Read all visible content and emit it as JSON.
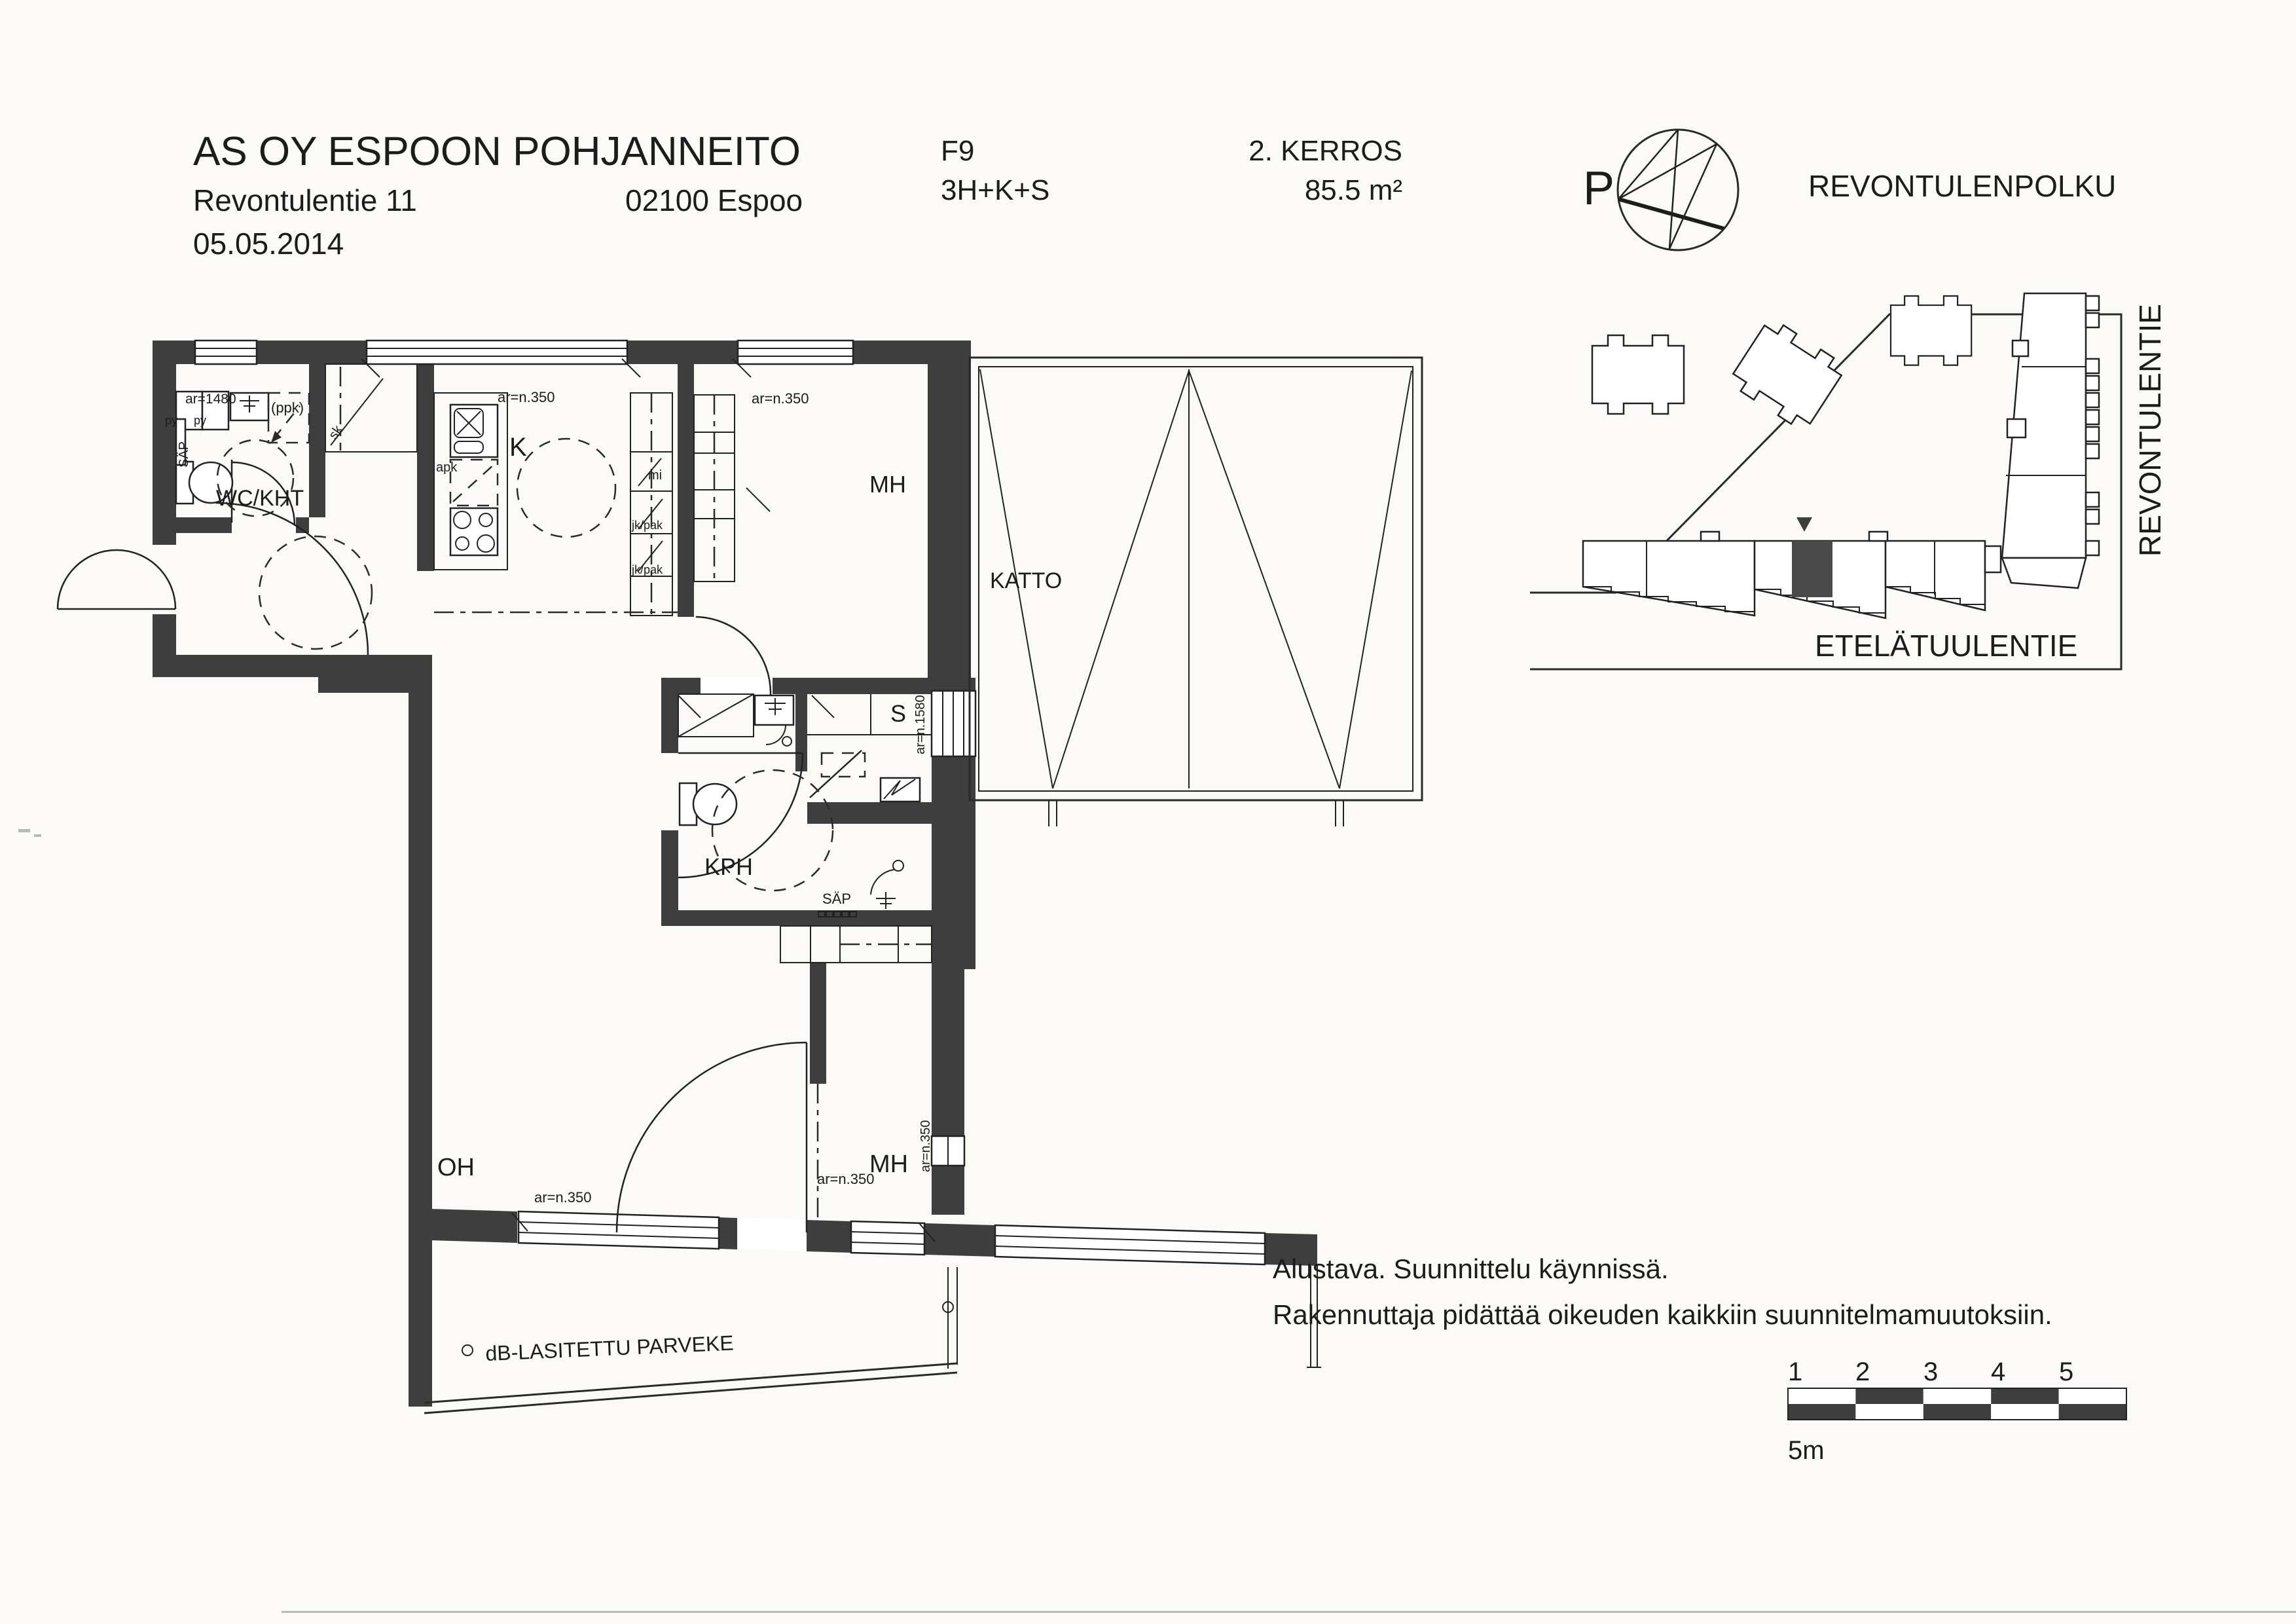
{
  "header": {
    "company": "AS OY ESPOON POHJANNEITO",
    "street_address": "Revontulentie 11",
    "postal_city": "02100 Espoo",
    "date": "05.05.2014",
    "apartment_id": "F9",
    "apartment_type": "3H+K+S",
    "floor_label": "2. KERROS",
    "area_label": "85.5 m²"
  },
  "compass": {
    "label": "P"
  },
  "site_plan": {
    "street_north": "REVONTULENPOLKU",
    "street_east": "REVONTULENTIE",
    "street_south": "ETELÄTUULENTIE"
  },
  "floor_plan": {
    "rooms": {
      "wc_utility": "WC/KHT",
      "kitchen": "K",
      "bedroom_top": "MH",
      "roof": "KATTO",
      "sauna": "S",
      "bathroom": "KPH",
      "living_room": "OH",
      "bedroom_bottom": "MH",
      "balcony": "dB-LASITETTU PARVEKE"
    },
    "annotations": {
      "ar_1480": "ar=1480",
      "ar_n350": "ar=n.350",
      "ar_n1580": "ar=n.1580",
      "py": "py",
      "ppk": "(ppk)",
      "sap": "SÄP",
      "sk": "sk",
      "apk": "apk",
      "mi": "mi",
      "jk_pak": "jk/pak"
    }
  },
  "notes": {
    "line1": "Alustava. Suunnittelu käynnissä.",
    "line2": "Rakennuttaja pidättää oikeuden kaikkiin suunnitelmamuutoksiin."
  },
  "scale_bar": {
    "ticks": [
      "1",
      "2",
      "3",
      "4",
      "5"
    ],
    "unit_label": "5m"
  },
  "colors": {
    "ink": "#1c1c1c",
    "wall": "#3e3e3e",
    "paper": "#fbfaf7",
    "highlight_unit": "#4a4a4a"
  }
}
